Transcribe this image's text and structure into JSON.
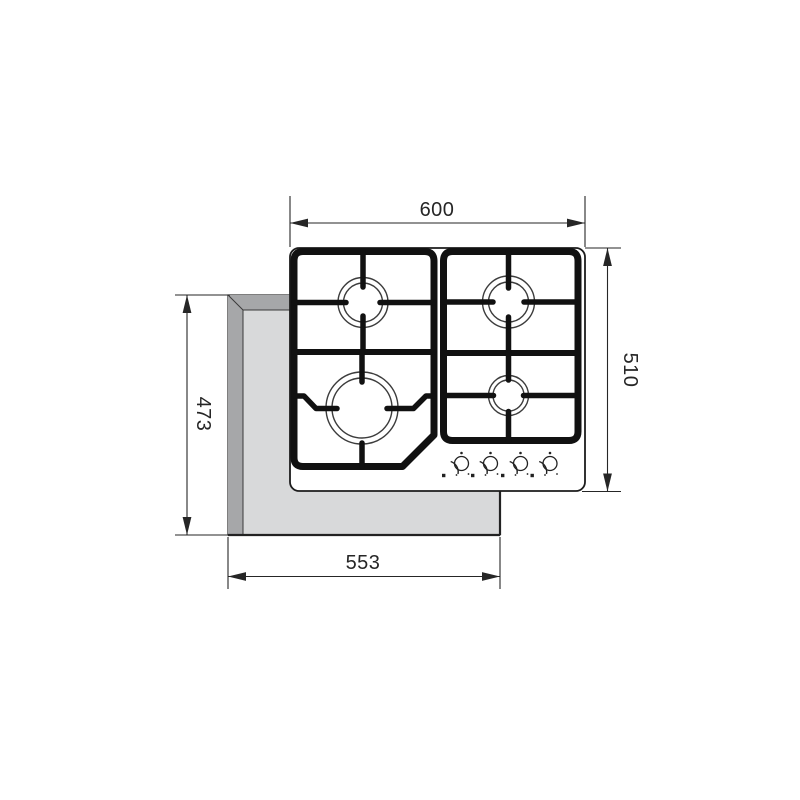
{
  "diagram": {
    "kind": "gas-hob-installation-drawing",
    "view": "top",
    "dimensions": {
      "hob_width": "600",
      "hob_depth": "510",
      "cutout_depth": "473",
      "cutout_width": "553"
    },
    "hob": {
      "grates": 2,
      "burner_count": 4,
      "burners": [
        "rear-left-medium",
        "front-left-large",
        "rear-right-medium",
        "front-right-small"
      ],
      "knob_count": 4
    },
    "colors": {
      "line": "#262626",
      "grate": "#111111",
      "panel_fill": "#ffffff",
      "counter_face": "#d8d9da",
      "counter_edge": "#a6a7a9"
    }
  }
}
